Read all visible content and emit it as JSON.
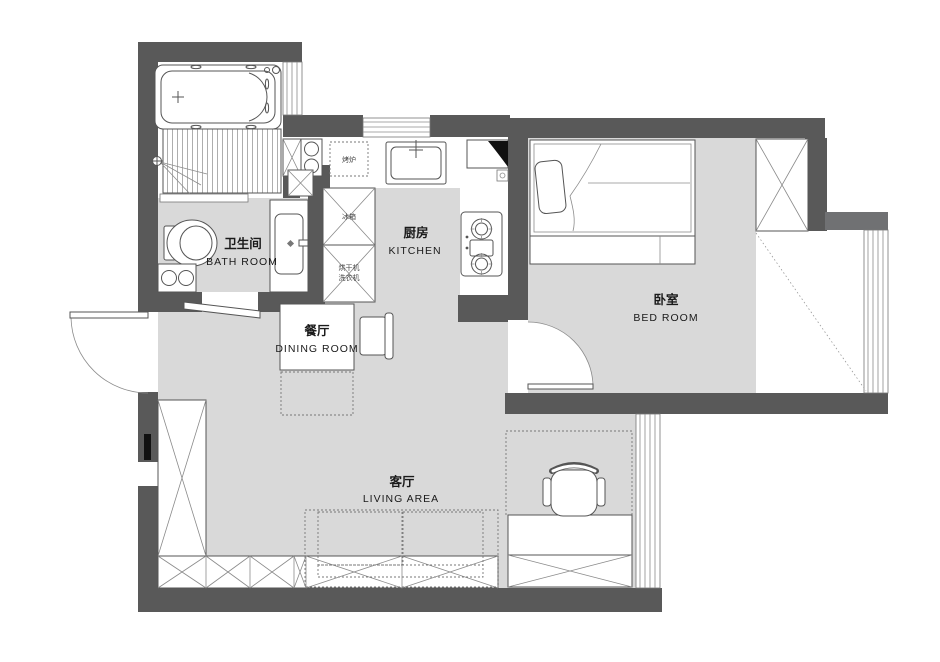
{
  "floorplan": {
    "rooms": {
      "bathroom": {
        "zh": "卫生间",
        "en": "BATH ROOM"
      },
      "kitchen": {
        "zh": "厨房",
        "en": "KITCHEN"
      },
      "dining": {
        "zh": "餐厅",
        "en": "DINING ROOM"
      },
      "bedroom": {
        "zh": "卧室",
        "en": "BED ROOM"
      },
      "living": {
        "zh": "客厅",
        "en": "LIVING  AREA"
      }
    },
    "appliances": {
      "oven": "烤炉",
      "fridge": "冰箱",
      "dryer": "烘干机",
      "washer": "洗衣机"
    },
    "colors": {
      "wall": "#595959",
      "wall_light": "#707173",
      "floor": "#d9d9d9",
      "line": "#555555",
      "paper": "#ffffff"
    }
  }
}
